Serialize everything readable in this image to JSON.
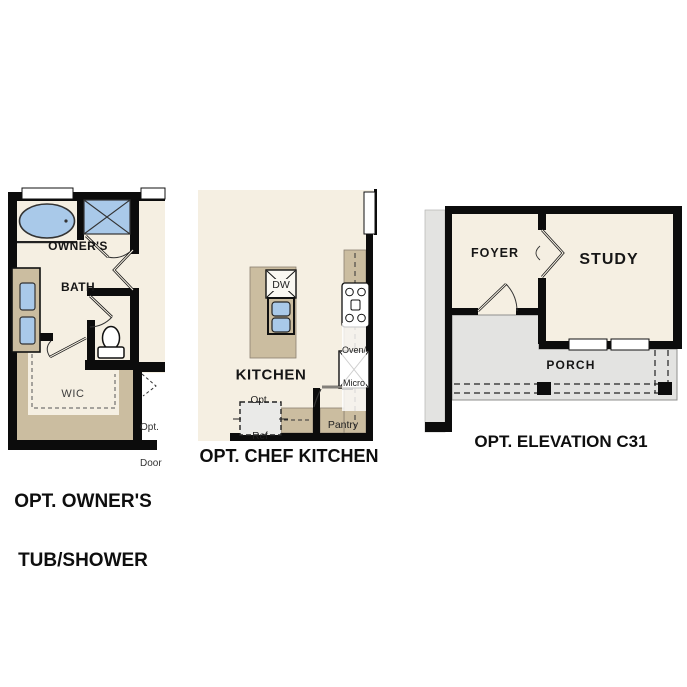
{
  "sheet": {
    "background": "#ffffff",
    "palette": {
      "floor_cream": "#f5efe2",
      "cabinet_tan": "#cbbda0",
      "fixture_blue": "#a9c9e9",
      "porch_gray": "#e3e3e1",
      "wall_black": "#0c0c0c",
      "optional_gray": "#eaeae8"
    }
  },
  "panels": {
    "owners_tub_shower": {
      "caption_line1": "OPT. OWNER'S",
      "caption_line2": "TUB/SHOWER",
      "labels": {
        "bath_line1": "OWNER'S",
        "bath_line2": "BATH",
        "wic": "WIC",
        "opt_door_line1": "Opt.",
        "opt_door_line2": "Door"
      },
      "fixtures": [
        "soaking-tub",
        "walk-in-shower",
        "double-sink-vanity",
        "toilet",
        "closet-shelving",
        "windows"
      ]
    },
    "chef_kitchen": {
      "caption": "OPT. CHEF KITCHEN",
      "labels": {
        "kitchen": "KITCHEN",
        "dishwasher": "DW",
        "oven_line1": "Oven/",
        "oven_line2": "Micro",
        "ref_line1": "Opt.",
        "ref_line2": "Ref",
        "pantry": "Pantry"
      },
      "fixtures": [
        "kitchen-island",
        "double-sink",
        "cooktop",
        "counter",
        "window"
      ]
    },
    "elevation_c31": {
      "caption": "OPT. ELEVATION C31",
      "labels": {
        "foyer": "FOYER",
        "study": "STUDY",
        "porch": "PORCH"
      },
      "fixtures": [
        "french-doors",
        "entry-door",
        "windows",
        "porch-posts"
      ]
    }
  }
}
